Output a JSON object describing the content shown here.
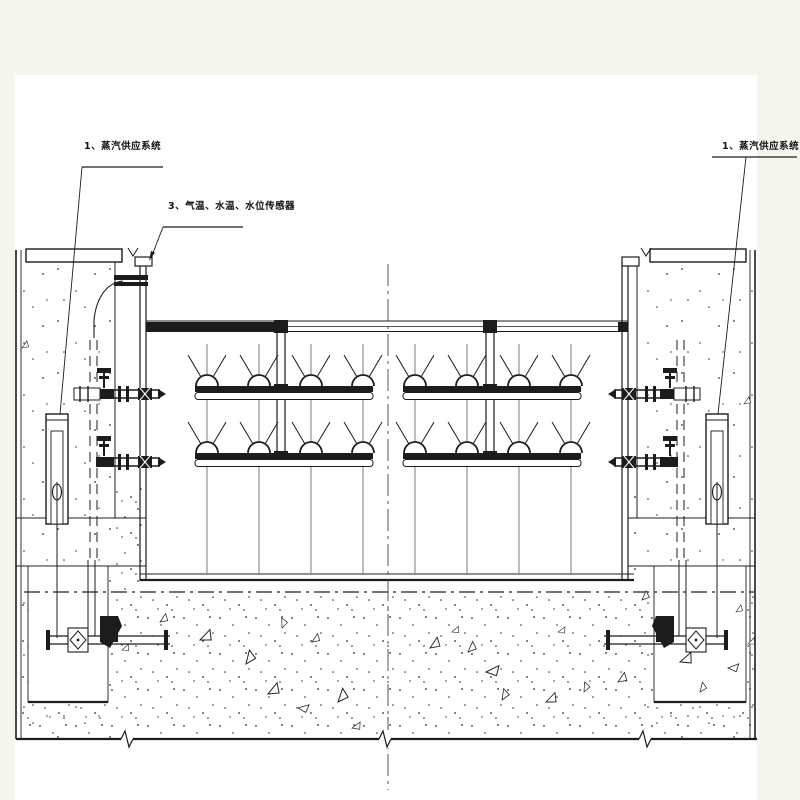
{
  "drawing": {
    "kind": "equipment-section-drawing",
    "colors": {
      "margin": "#f5f7ee",
      "paper": "#ffffff",
      "line": "#1c1c1c",
      "centerline": "#444444"
    },
    "labels": {
      "steam_left": {
        "text": "1、蒸汽供应系统"
      },
      "sensors": {
        "text": "3、气温、水温、水位传感器"
      },
      "steam_right": {
        "text": "1、蒸汽供应系统"
      }
    }
  }
}
